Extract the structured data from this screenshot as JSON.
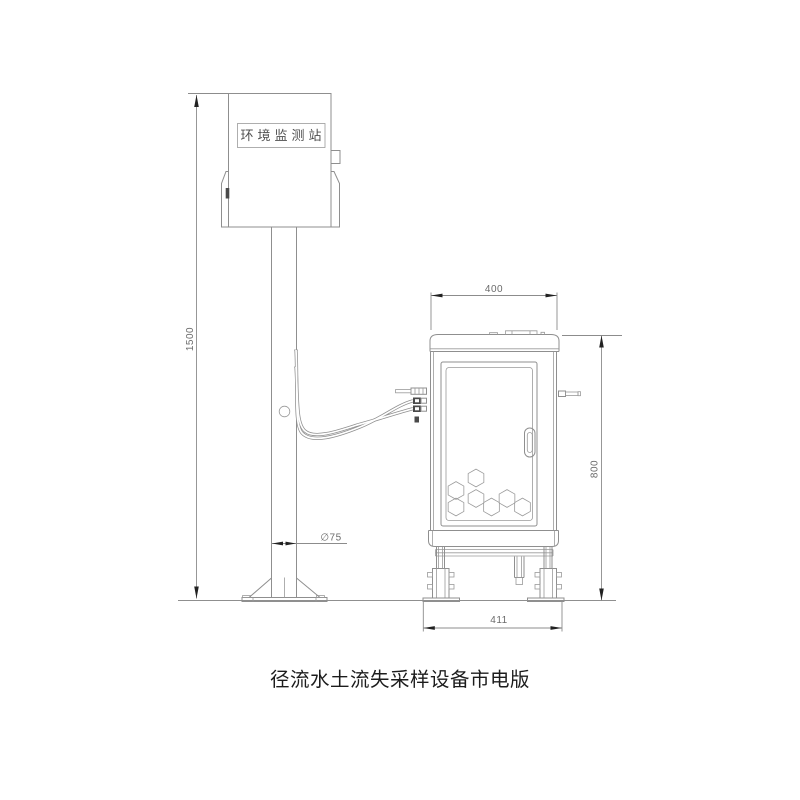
{
  "drawing": {
    "caption": "径流水土流失采样设备市电版",
    "station_box": {
      "label": "环境监测站"
    },
    "dimensions": {
      "pole_height": "1500",
      "pole_diameter": "∅75",
      "cabinet_width": "400",
      "cabinet_height": "800",
      "base_width": "411"
    },
    "colors": {
      "line": "#8f8f8f",
      "dimension_text": "#6b6b6b",
      "arrow": "#222222",
      "station_label_text": "#4f4f4f",
      "caption_text": "#1c1c1c",
      "background": "#ffffff"
    }
  }
}
